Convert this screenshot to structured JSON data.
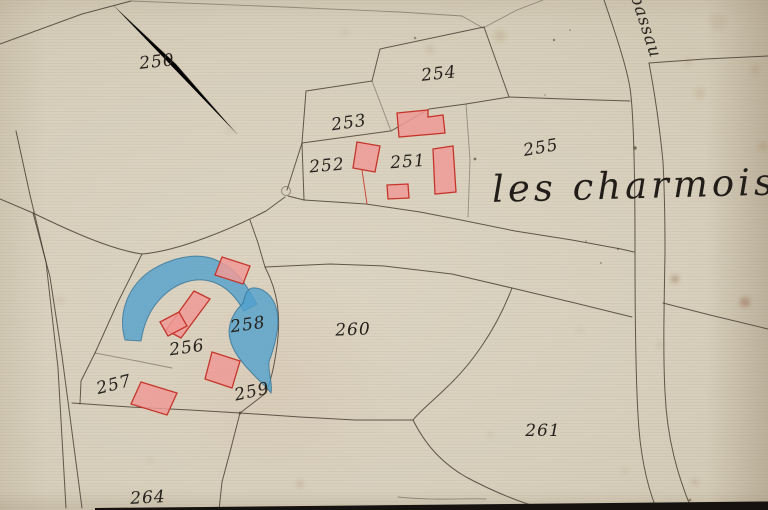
{
  "map": {
    "title_label": "les charmois.",
    "road_label": "bassau",
    "parcels": [
      {
        "id": "250"
      },
      {
        "id": "253"
      },
      {
        "id": "252"
      },
      {
        "id": "251"
      },
      {
        "id": "254"
      },
      {
        "id": "255"
      },
      {
        "id": "256"
      },
      {
        "id": "257"
      },
      {
        "id": "258"
      },
      {
        "id": "259"
      },
      {
        "id": "260"
      },
      {
        "id": "261"
      },
      {
        "id": "264"
      }
    ],
    "colors": {
      "paper": "#d8d0bd",
      "boundary_ink": "#453c30",
      "label_ink": "#26211b",
      "building_fill": "#ef9a97",
      "building_stroke": "#c5352b",
      "water_fill": "#4fa0cd",
      "water_stroke": "#2f6f94",
      "scan_edge": "#151210"
    }
  }
}
